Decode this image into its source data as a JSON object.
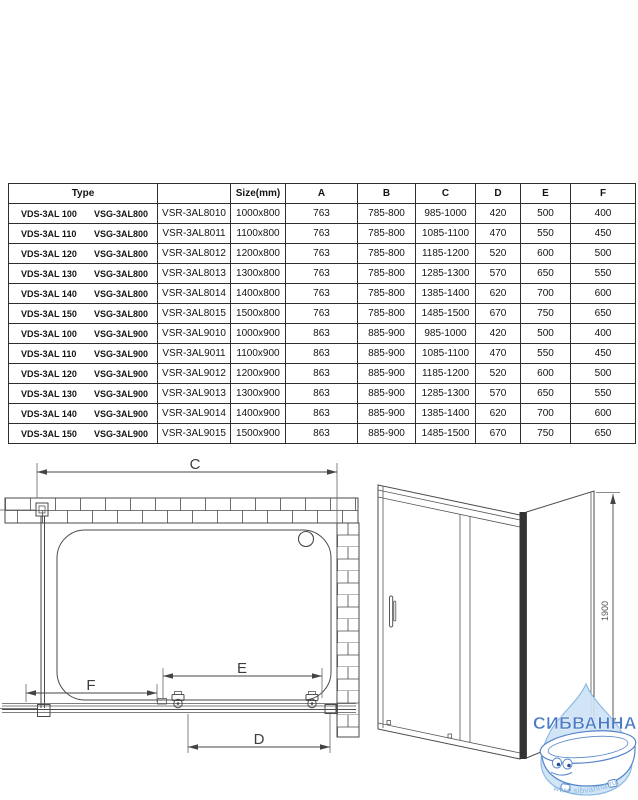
{
  "table": {
    "headers": [
      "Type",
      "",
      "Size(mm)",
      "A",
      "B",
      "C",
      "D",
      "E",
      "F"
    ],
    "rows": [
      {
        "type_vds": "VDS-3AL 100",
        "type_vsg": "VSG-3AL800",
        "model": "VSR-3AL8010",
        "size": "1000x800",
        "a": "763",
        "b": "785-800",
        "c": "985-1000",
        "d": "420",
        "e": "500",
        "f": "400"
      },
      {
        "type_vds": "VDS-3AL 110",
        "type_vsg": "VSG-3AL800",
        "model": "VSR-3AL8011",
        "size": "1100x800",
        "a": "763",
        "b": "785-800",
        "c": "1085-1100",
        "d": "470",
        "e": "550",
        "f": "450"
      },
      {
        "type_vds": "VDS-3AL 120",
        "type_vsg": "VSG-3AL800",
        "model": "VSR-3AL8012",
        "size": "1200x800",
        "a": "763",
        "b": "785-800",
        "c": "1185-1200",
        "d": "520",
        "e": "600",
        "f": "500"
      },
      {
        "type_vds": "VDS-3AL 130",
        "type_vsg": "VSG-3AL800",
        "model": "VSR-3AL8013",
        "size": "1300x800",
        "a": "763",
        "b": "785-800",
        "c": "1285-1300",
        "d": "570",
        "e": "650",
        "f": "550"
      },
      {
        "type_vds": "VDS-3AL 140",
        "type_vsg": "VSG-3AL800",
        "model": "VSR-3AL8014",
        "size": "1400x800",
        "a": "763",
        "b": "785-800",
        "c": "1385-1400",
        "d": "620",
        "e": "700",
        "f": "600"
      },
      {
        "type_vds": "VDS-3AL 150",
        "type_vsg": "VSG-3AL800",
        "model": "VSR-3AL8015",
        "size": "1500x800",
        "a": "763",
        "b": "785-800",
        "c": "1485-1500",
        "d": "670",
        "e": "750",
        "f": "650"
      },
      {
        "type_vds": "VDS-3AL 100",
        "type_vsg": "VSG-3AL900",
        "model": "VSR-3AL9010",
        "size": "1000x900",
        "a": "863",
        "b": "885-900",
        "c": "985-1000",
        "d": "420",
        "e": "500",
        "f": "400"
      },
      {
        "type_vds": "VDS-3AL 110",
        "type_vsg": "VSG-3AL900",
        "model": "VSR-3AL9011",
        "size": "1100x900",
        "a": "863",
        "b": "885-900",
        "c": "1085-1100",
        "d": "470",
        "e": "550",
        "f": "450"
      },
      {
        "type_vds": "VDS-3AL 120",
        "type_vsg": "VSG-3AL900",
        "model": "VSR-3AL9012",
        "size": "1200x900",
        "a": "863",
        "b": "885-900",
        "c": "1185-1200",
        "d": "520",
        "e": "600",
        "f": "500"
      },
      {
        "type_vds": "VDS-3AL 130",
        "type_vsg": "VSG-3AL900",
        "model": "VSR-3AL9013",
        "size": "1300x900",
        "a": "863",
        "b": "885-900",
        "c": "1285-1300",
        "d": "570",
        "e": "650",
        "f": "550"
      },
      {
        "type_vds": "VDS-3AL 140",
        "type_vsg": "VSG-3AL900",
        "model": "VSR-3AL9014",
        "size": "1400x900",
        "a": "863",
        "b": "885-900",
        "c": "1385-1400",
        "d": "620",
        "e": "700",
        "f": "600"
      },
      {
        "type_vds": "VDS-3AL 150",
        "type_vsg": "VSG-3AL900",
        "model": "VSR-3AL9015",
        "size": "1500x900",
        "a": "863",
        "b": "885-900",
        "c": "1485-1500",
        "d": "670",
        "e": "750",
        "f": "650"
      }
    ]
  },
  "plan_view": {
    "dim_c": "C",
    "dim_e": "E",
    "dim_f": "F",
    "dim_d": "D"
  },
  "elevation_view": {
    "height_label": "1900"
  },
  "watermark": {
    "brand": "СИБВАННА",
    "url": "www.sibvanna.ru"
  },
  "colors": {
    "line_art": "#4a4a4a",
    "table_border": "#2e2e2e",
    "watermark_brand": "#4a7ac6",
    "watermark_drop_fill": "#cde3f5",
    "watermark_drop_stroke": "#85b7e2",
    "watermark_tub_stroke": "#5585c8",
    "watermark_url": "#8fb9de"
  }
}
